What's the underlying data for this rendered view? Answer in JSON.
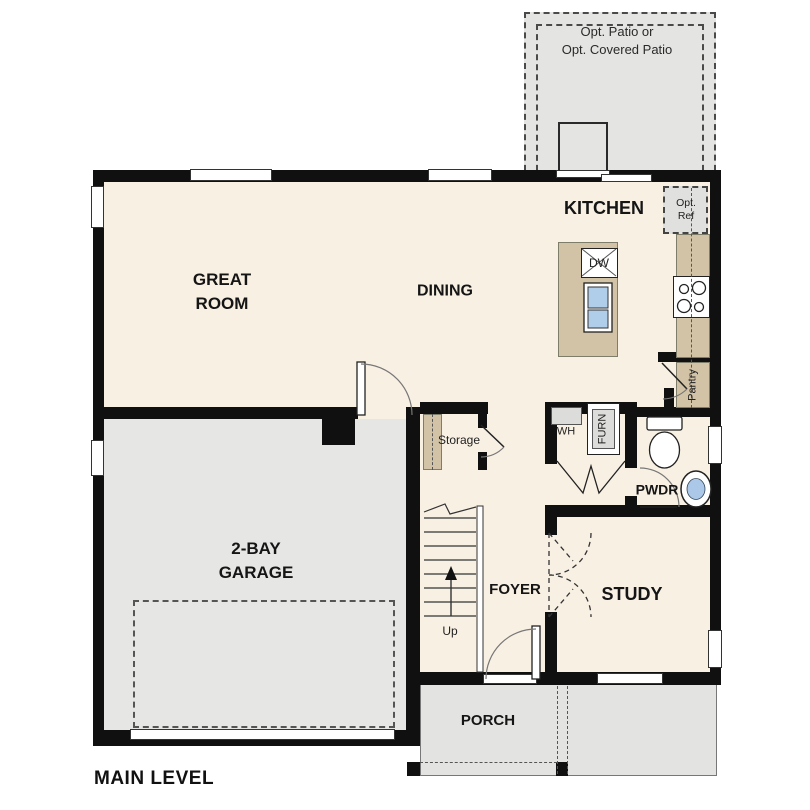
{
  "plan": {
    "title": "MAIN LEVEL",
    "patio": {
      "line1": "Opt. Patio or",
      "line2": "Opt. Covered Patio"
    },
    "rooms": {
      "kitchen": "KITCHEN",
      "great_room": {
        "line1": "GREAT",
        "line2": "ROOM"
      },
      "dining": "DINING",
      "garage": {
        "line1": "2-BAY",
        "line2": "GARAGE"
      },
      "foyer": "FOYER",
      "study": "STUDY",
      "porch": "PORCH",
      "powder": "PWDR"
    },
    "labels": {
      "storage": "Storage",
      "pantry": "Pantry",
      "water_heater": "WH",
      "furnace": "FURN",
      "dishwasher": "DW",
      "opt_ref": {
        "line1": "Opt.",
        "line2": "Ref"
      },
      "stairs_up": "Up"
    },
    "colors": {
      "wall": "#101010",
      "floor_interior": "#f8f0e3",
      "floor_garage": "#e6e6e4",
      "floor_patio": "#e4e4e2",
      "floor_porch": "#e3e3e1",
      "counter": "#d2c3a6",
      "sink_water": "#b0cdea",
      "appliance_gray": "#dcdcda"
    },
    "fixtures": [
      "kitchen-island",
      "kitchen-sink",
      "dishwasher",
      "range-cooktop",
      "optional-refrigerator",
      "pantry-shelf",
      "water-heater",
      "furnace",
      "toilet",
      "powder-sink",
      "stairs",
      "storage-shelf"
    ]
  }
}
